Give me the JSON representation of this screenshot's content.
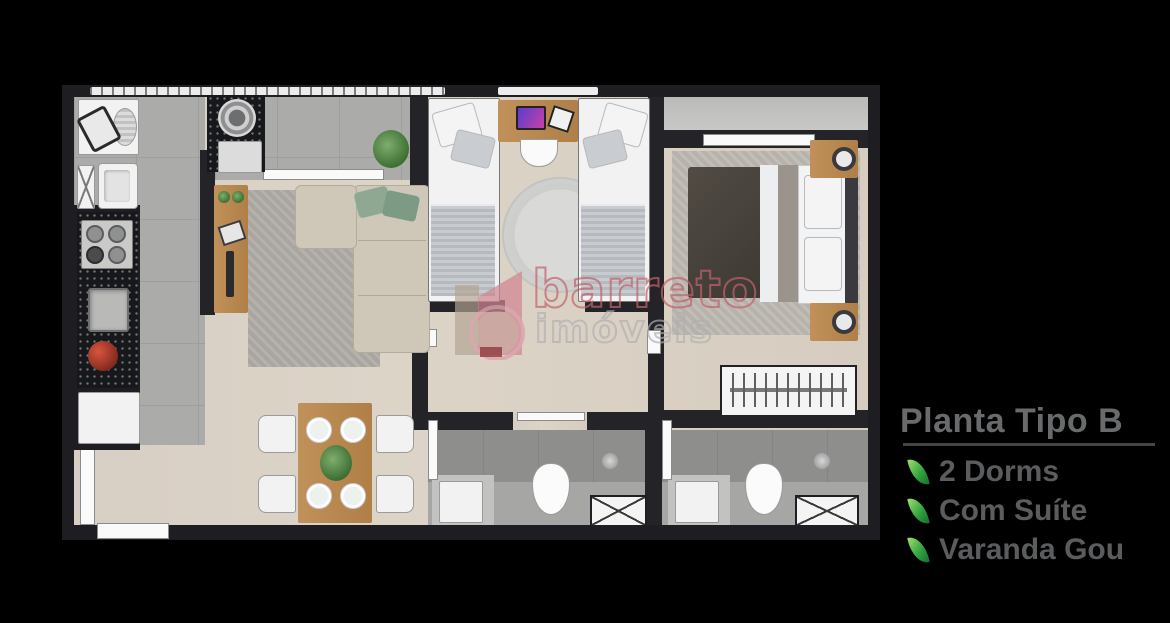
{
  "background_color": "#000000",
  "panel": {
    "title": "Planta Tipo B",
    "title_color": "#696a6c",
    "item_color": "#5b5c5e",
    "leaf_color": "#2e9e3e",
    "items": [
      {
        "icon": "leaf-icon",
        "label": "2 Dorms"
      },
      {
        "icon": "leaf-icon",
        "label": "Com Suíte"
      },
      {
        "icon": "leaf-icon",
        "label": "Varanda Gou"
      }
    ]
  },
  "watermark": {
    "logo_icon": "barreto-imoveis-logo",
    "line1": "barreto",
    "line2": "imóveis",
    "line1_color": "#c1616c",
    "line2_color": "#afafb2"
  },
  "floorplan": {
    "type": "apartment-top-view-render",
    "wall_color": "#242428",
    "wood_floor_color": "#d8cfc4",
    "tile_floor_color": "#abacaa",
    "bathroom_floor_color": "#a6a7a5",
    "rooms": [
      "kitchen-laundry-strip",
      "varanda-gourmet",
      "living-room",
      "dining-area",
      "bedroom-2-twin",
      "master-suite",
      "suite-balcony",
      "hallway",
      "social-bathroom",
      "suite-bathroom"
    ],
    "furniture": [
      "washing-machine",
      "laundry-tank",
      "cabinet",
      "stove",
      "kitchen-sink",
      "fruit-bowl",
      "fridge",
      "grill",
      "grill-cabinet",
      "balcony-counter",
      "plant",
      "tv-console",
      "area-rug",
      "l-shaped-sofa",
      "green-pillows",
      "dining-table",
      "dining-chairs",
      "place-settings",
      "centerpiece-plant",
      "twin-bed",
      "desk",
      "desk-chair",
      "round-rug",
      "double-bed",
      "nightstand",
      "table-lamp",
      "wardrobe-with-hangers",
      "toilet",
      "bathroom-sink",
      "shower-box",
      "entry-door",
      "sliding-door",
      "window-railing"
    ]
  }
}
